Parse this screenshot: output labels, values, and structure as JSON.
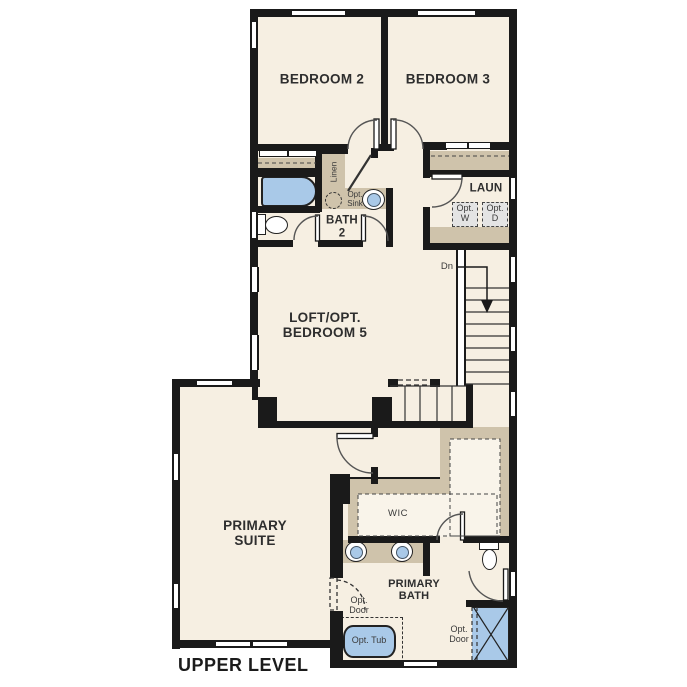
{
  "title": "UPPER LEVEL",
  "rooms": {
    "bedroom2": "BEDROOM 2",
    "bedroom3": "BEDROOM 3",
    "bath2": {
      "l1": "BATH",
      "l2": "2"
    },
    "laundry": "LAUN",
    "loft": {
      "l1": "LOFT/OPT.",
      "l2": "BEDROOM 5"
    },
    "primary_suite": {
      "l1": "PRIMARY",
      "l2": "SUITE"
    },
    "wic": "WIC",
    "primary_bath": {
      "l1": "PRIMARY",
      "l2": "BATH"
    }
  },
  "labels": {
    "linen": "Linen",
    "opt_sink": {
      "l1": "Opt.",
      "l2": "Sink"
    },
    "opt_washer": {
      "l1": "Opt.",
      "l2": "W"
    },
    "opt_dryer": {
      "l1": "Opt.",
      "l2": "D"
    },
    "down": "Dn",
    "opt_door_bath": {
      "l1": "Opt.",
      "l2": "Door"
    },
    "opt_tub": "Opt. Tub",
    "opt_door_shower": {
      "l1": "Opt.",
      "l2": "Door"
    }
  },
  "colors": {
    "floor": "#f6efe2",
    "floor_light": "#f9f4ea",
    "casework": "#cfc3ab",
    "fixture_blue": "#a9c9e8",
    "wall": "#1a1a1a",
    "appliance": "#e4e4e4",
    "text": "#2e2e2e"
  }
}
